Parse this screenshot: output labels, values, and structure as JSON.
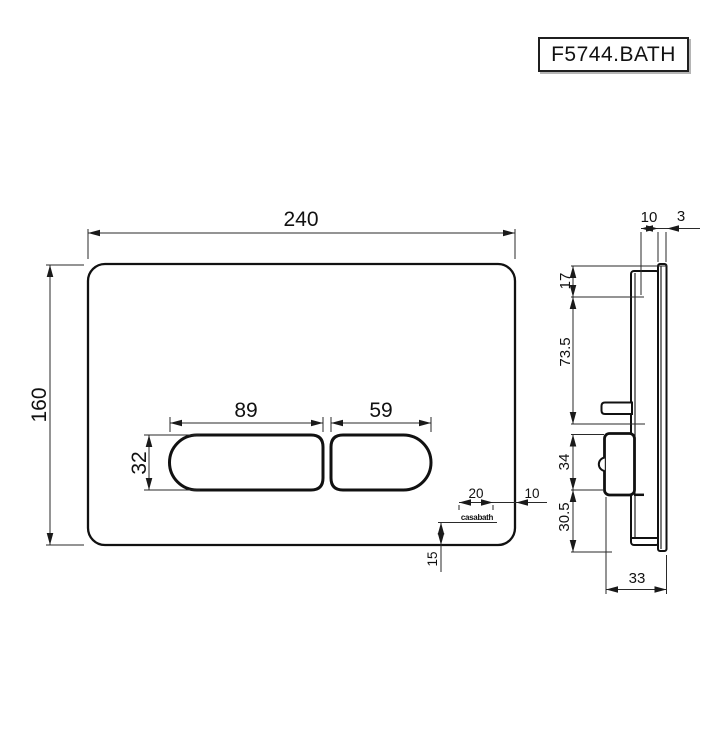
{
  "title_box": {
    "code": "F5744.BATH"
  },
  "front_view": {
    "plate_width": "240",
    "plate_height": "160",
    "large_button_width": "89",
    "small_button_width": "59",
    "button_height": "32",
    "logo_width": "20",
    "logo_right_offset": "10",
    "logo_bottom_offset": "15",
    "brand_logo": "casabath"
  },
  "side_view": {
    "frame_depth": "10",
    "plate_thickness": "3",
    "top_clearance": "17",
    "upper_body_height": "73.5",
    "mechanism_height": "34",
    "lower_body_height": "30.5",
    "overall_depth": "33"
  },
  "colors": {
    "line": "#1a1a1a",
    "background": "#ffffff"
  }
}
